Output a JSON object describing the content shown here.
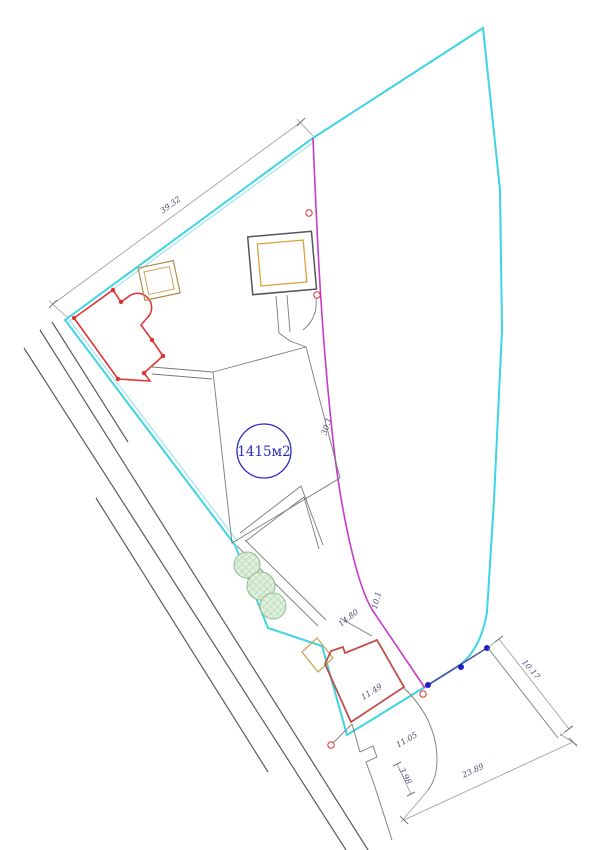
{
  "drawing": {
    "title": "site-plan",
    "area_label": "1415м2",
    "labels": {
      "edge_top_left": "39.32",
      "seg_mid": "30.1",
      "seg_bend_upper": "10.1",
      "seg_bend_lower": "14.80",
      "building_len": "11.49",
      "building_offset": "11.05",
      "east_edge": "10.17",
      "road_front": "23.89",
      "road_gap": "3.98"
    },
    "colors": {
      "outer_boundary": "#3fd3e4",
      "outer_boundary_light": "#8fe2ee",
      "inner_boundary": "#c73bc7",
      "survey_segment": "#5a4d9e",
      "survey_point": "#1f1fbf",
      "boundary_marker": "#e03030",
      "building_main": "#e23535",
      "building_secondary": "#c0504d",
      "structure_tan": "#c8a050",
      "structure_orange": "#d7a13b",
      "paths_gray": "#7a7a7a",
      "road_gray": "#5c5c5c",
      "dimension_gray": "#9a9a9a",
      "text_blue": "#2a2ac0",
      "tree_stroke": "#8fbf8f",
      "tree_fill": "#dfeedd"
    }
  }
}
